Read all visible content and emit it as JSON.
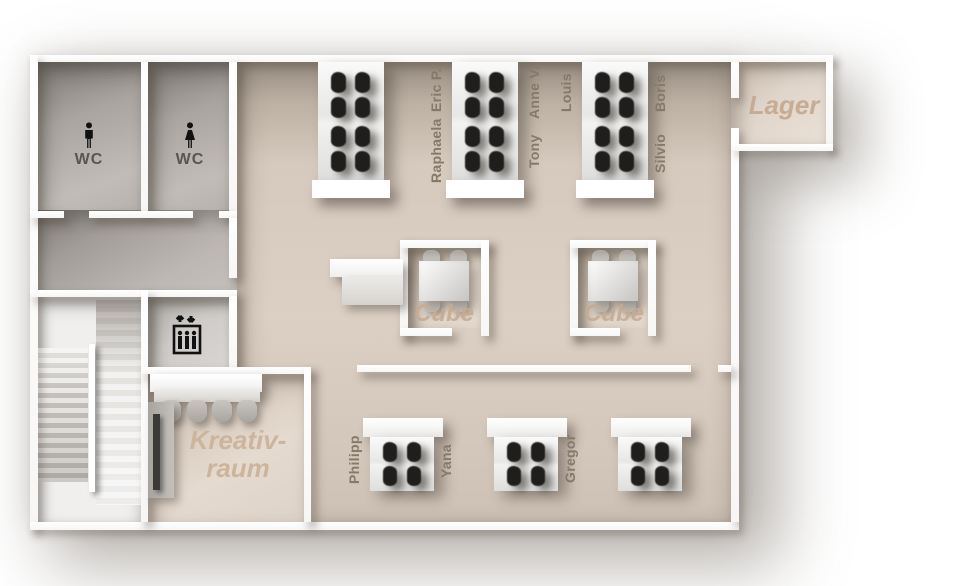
{
  "floorplan": {
    "rooms": {
      "wc_left": {
        "label": "WC",
        "icon": "male-icon"
      },
      "wc_right": {
        "label": "WC",
        "icon": "female-icon"
      },
      "lager": {
        "label": "Lager"
      },
      "kreativraum": {
        "line1": "Kreativ-",
        "line2": "raum"
      },
      "cube_left": {
        "label": "Cube"
      },
      "cube_right": {
        "label": "Cube"
      },
      "elevator": {
        "icon": "elevator-icon"
      }
    },
    "top_pods": [
      {
        "id": "desk-pod-1",
        "labels": {}
      },
      {
        "id": "desk-pod-2",
        "labels": {
          "left_top": "Eric P.",
          "left_bottom": "Raphaela",
          "right_top": "Anne V.",
          "right_bottom": "Tony"
        }
      },
      {
        "id": "desk-pod-3",
        "labels": {
          "left_top": "Louis",
          "right_top": "Boris",
          "right_bottom": "Silvio"
        }
      }
    ],
    "bottom_pods": [
      {
        "id": "desk-pod-4",
        "labels": {
          "left": "Philipp",
          "right": "Yana"
        }
      },
      {
        "id": "desk-pod-5",
        "labels": {
          "right": "Gregor"
        }
      },
      {
        "id": "desk-pod-6",
        "labels": {}
      }
    ],
    "colors": {
      "floor_beige": "#d9ccc0",
      "floor_gray": "#b8b3ae",
      "room_label": "#c7ab92",
      "name_label": "#857969"
    }
  }
}
